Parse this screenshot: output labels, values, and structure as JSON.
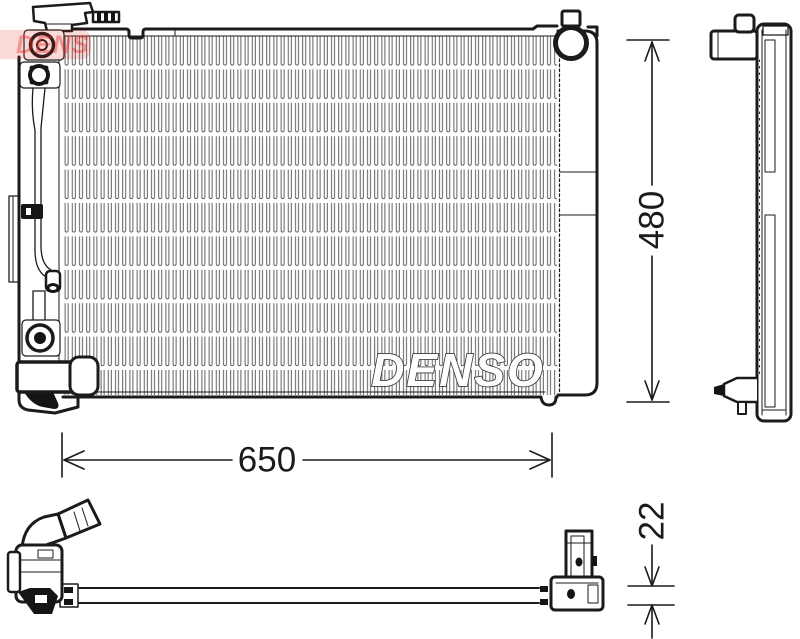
{
  "drawing": {
    "watermarks": {
      "core_text": "DENSO",
      "logo_text": "DENSO"
    },
    "dimensions": {
      "core_width": {
        "label": "650"
      },
      "core_height": {
        "label": "480"
      },
      "core_thickness": {
        "label": "22"
      }
    },
    "colors": {
      "line": "#1b1b1b",
      "fin": "#4f4f4f",
      "brand_red": "#e2241e"
    }
  }
}
